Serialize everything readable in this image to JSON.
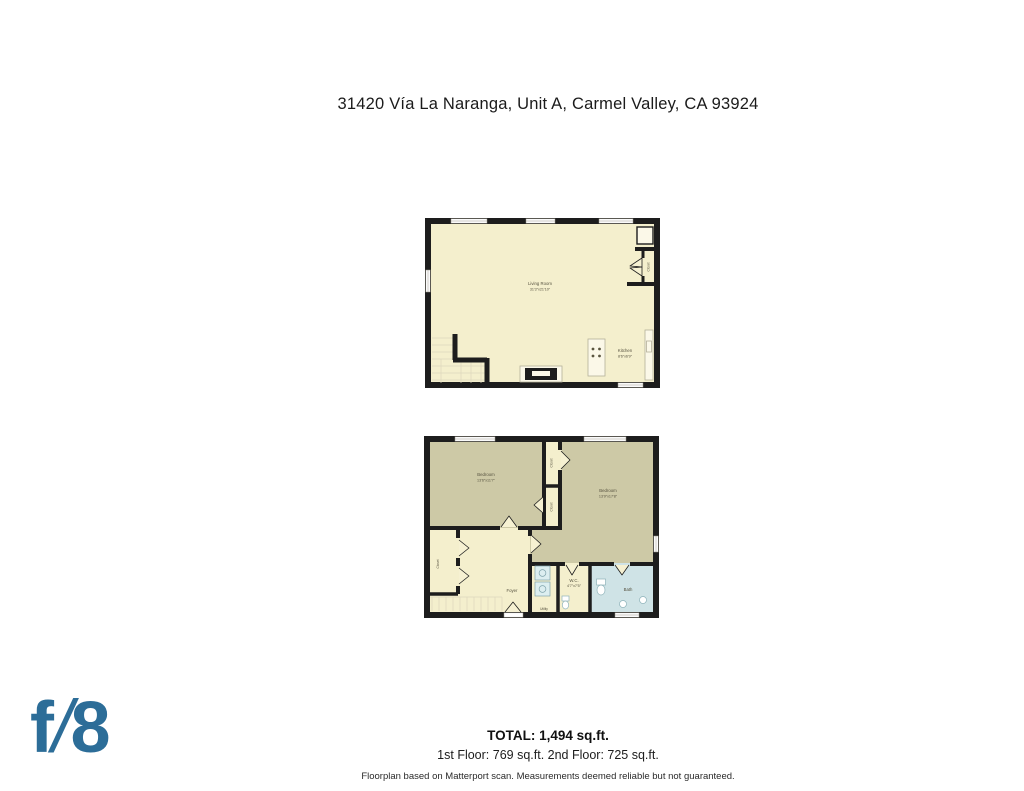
{
  "page": {
    "title": "31420 Vía La Naranga, Unit A, Carmel Valley, CA 93924"
  },
  "logo": {
    "f": "f",
    "slash": "/",
    "eight": "8",
    "color": "#2c6d98"
  },
  "floor1": {
    "living_room": {
      "name": "Living Room",
      "dims": "31'3\"x21'10\""
    },
    "kitchen": {
      "name": "Kitchen",
      "dims": "8'6\"x6'9\""
    },
    "closet": {
      "name": "Closet"
    }
  },
  "floor2": {
    "bedroom_left": {
      "name": "Bedroom",
      "dims": "13'6\"x11'7\""
    },
    "bedroom_right": {
      "name": "Bedroom",
      "dims": "13'9\"x17'8\""
    },
    "closet_top": {
      "name": "Closet"
    },
    "closet_mid": {
      "name": "Closet"
    },
    "closet_left": {
      "name": "Closet"
    },
    "foyer": {
      "name": "Foyer"
    },
    "wc": {
      "name": "W.C.",
      "dims": "4'7\"x7'5\""
    },
    "utility": {
      "name": "Utility"
    },
    "bath": {
      "name": "Bath"
    }
  },
  "footer": {
    "total": "TOTAL: 1,494 sq.ft.",
    "floors": "1st Floor: 769 sq.ft. 2nd Floor: 725 sq.ft.",
    "disclaimer": "Floorplan based on Matterport scan. Measurements deemed reliable but not guaranteed."
  },
  "colors": {
    "wall": "#1d1d1d",
    "floor_cream": "#f4efcd",
    "floor_olive": "#cdc9a6",
    "floor_blue": "#cfe3e6"
  }
}
